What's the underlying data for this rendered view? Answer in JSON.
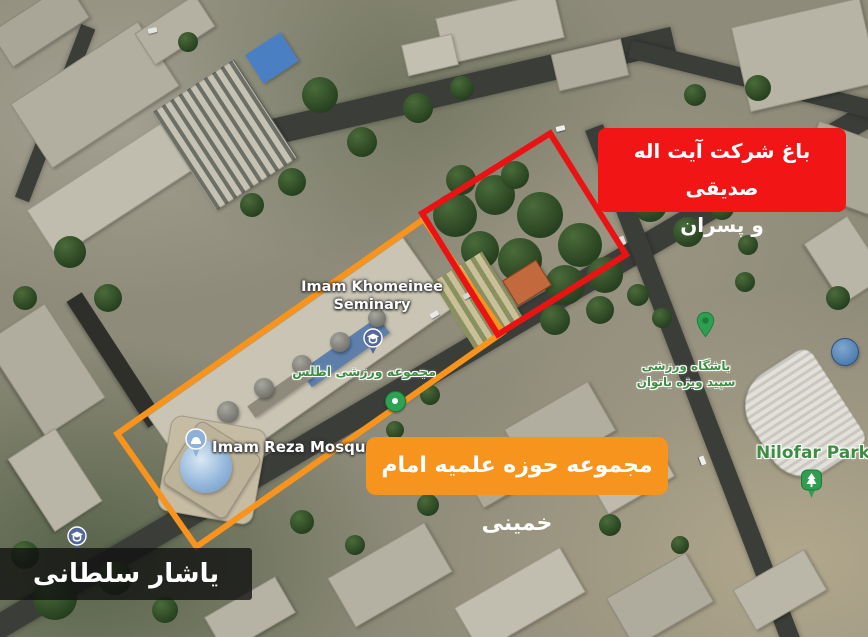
{
  "annotations": {
    "garden_label": {
      "line1": "باغ شرکت آیت اله صدیقی",
      "line2": "و پسران",
      "bg_color": "#f21515"
    },
    "seminary_label": {
      "text": "مجموعه حوزه علمیه امام خمینی",
      "bg_color": "#f7941d"
    },
    "credit_label": {
      "text": "یاشار سلطانی",
      "bg_color": "#141414"
    },
    "boundaries": {
      "garden_outline_color": "#ea1313",
      "seminary_outline_color": "#f7941d"
    }
  },
  "map_labels": {
    "seminary": {
      "line1": "Imam Khomeinee",
      "line2": "Seminary",
      "color": "#ffffff"
    },
    "mosque": {
      "text": "Imam Reza Mosque",
      "color": "#ffffff"
    },
    "atlas": {
      "text": "مجموعه ورزشی اطلس",
      "color": "#3e8e41"
    },
    "sepid": {
      "line1": "باشگاه ورزشی",
      "line2": "سپید ویژه بانوان",
      "color": "#3e8e41"
    },
    "nilofar": {
      "text": "Nilofar Park",
      "color": "#3e8e41"
    }
  },
  "map_icons": {
    "school_pin_color": "#54689c",
    "mosque_pin_color": "#8fb0d8",
    "poi_green": "#2f9e51"
  }
}
